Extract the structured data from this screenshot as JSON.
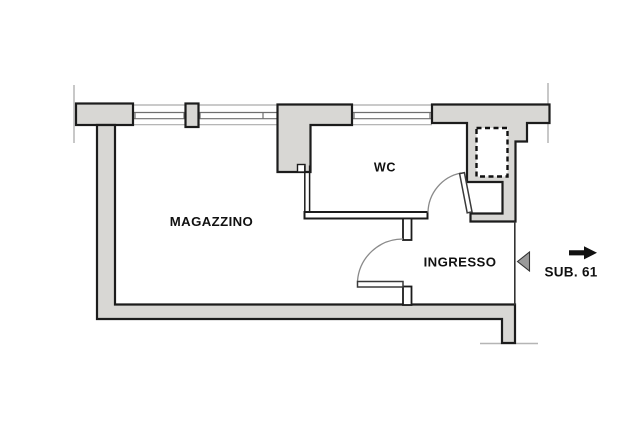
{
  "plan": {
    "rooms": [
      {
        "label": "MAGAZZINO"
      },
      {
        "label": "WC"
      },
      {
        "label": "INGRESSO"
      }
    ],
    "annotation": {
      "sub_label": "SUB. 61"
    }
  },
  "icons": {
    "entrance_direction": "right-arrow",
    "entrance_marker": "left-triangle"
  },
  "colors": {
    "wall_fill": "#d8d7d4",
    "outline": "#1c1c1c",
    "thin_line": "#b5b5b5",
    "arrow_fill": "#111111",
    "triangle_fill": "#9a9a9a",
    "background": "#ffffff"
  }
}
